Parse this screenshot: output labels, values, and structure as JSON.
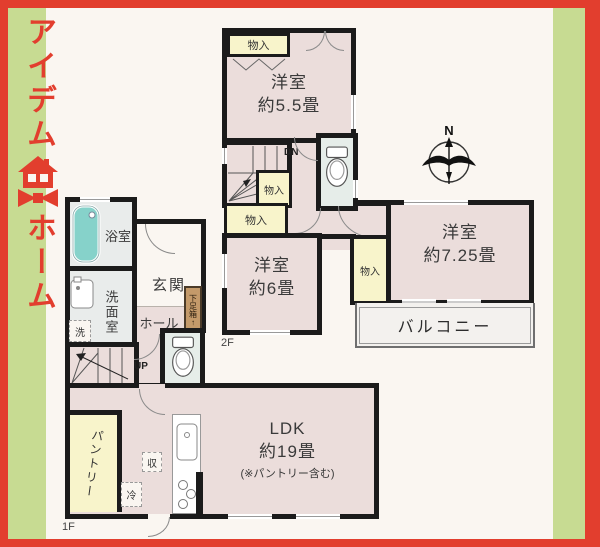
{
  "logo": {
    "line1": "アイデム",
    "line2": "ホーム"
  },
  "compass": {
    "north": "N"
  },
  "labels": {
    "floor1": "1F",
    "floor2": "2F",
    "up": "UP",
    "down": "DN",
    "closet": "物入",
    "shoebox": "下足箱",
    "shoebox_arrow": "↑",
    "bath": "浴室",
    "entrance": "玄関",
    "washroom": "洗面室",
    "hall": "ホール",
    "laundry": "洗",
    "storage": "収",
    "fridge": "冷",
    "pantry": "パントリー",
    "balcony": "バルコニー"
  },
  "rooms": {
    "bed55": {
      "title": "洋室",
      "size": "約5.5畳"
    },
    "bed6": {
      "title": "洋室",
      "size": "約6畳"
    },
    "bed725": {
      "title": "洋室",
      "size": "約7.25畳"
    },
    "ldk": {
      "title": "LDK",
      "size": "約19畳",
      "note": "(※パントリー含む)"
    }
  },
  "colors": {
    "frame_red": "#e23e2e",
    "band_green": "#c7db92",
    "panel": "#faf6f1",
    "room_pink": "#ebdddb",
    "closet_cream": "#f8f4cb",
    "wet_gray": "#e9eceb",
    "toilet_green": "#e6ede9",
    "shoebox_tan": "#c49a6a",
    "tub_teal": "#86d2ca",
    "wall_black": "#1b1b1b"
  }
}
